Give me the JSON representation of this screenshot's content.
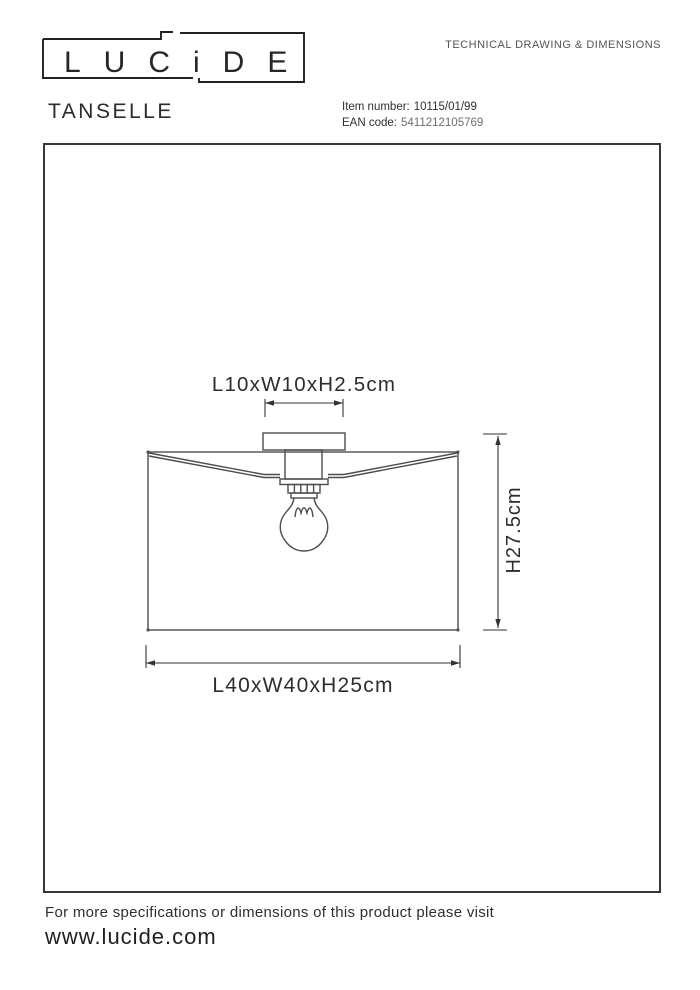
{
  "header": {
    "logo_text": "LUCiDE",
    "product_name": "TANSELLE",
    "doc_title": "TECHNICAL DRAWING & DIMENSIONS",
    "item_number_label": "Item number:",
    "item_number_value": "10115/01/99",
    "ean_label": "EAN code:",
    "ean_value": "5411212105769"
  },
  "drawing": {
    "dimensions": {
      "canopy": "L10xW10xH2.5cm",
      "total_height": "H27.5cm",
      "shade": "L40xW40xH25cm"
    }
  },
  "footer": {
    "note": "For more specifications or dimensions of this product please visit",
    "website": "www.lucide.com"
  },
  "colors": {
    "ink": "#2d2d2d",
    "line_work": "#4d4d4d",
    "muted_text": "#6e6e6e",
    "background": "#ffffff"
  }
}
